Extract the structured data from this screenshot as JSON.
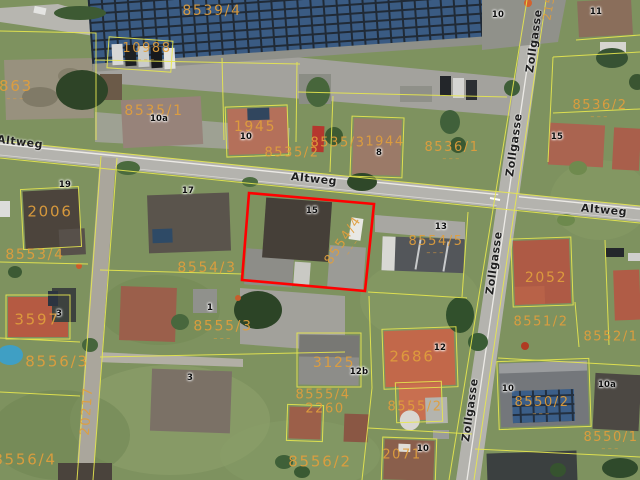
{
  "map": {
    "type": "aerial-cadastral-view",
    "colors": {
      "parcel_line": "#e8e84f",
      "parcel_label": "#e09e3c",
      "selection_outline": "#ff0000",
      "road": "#b4b3ae"
    },
    "selected_parcel": {
      "number": "8554/4",
      "house_number": "15",
      "outline_color": "#ff0000",
      "outline_points": "249,193 374,204 365,291 242,280"
    },
    "street_labels": [
      {
        "text": "Altweg",
        "x": 20,
        "y": 142,
        "rot": 7
      },
      {
        "text": "Altweg",
        "x": 314,
        "y": 179,
        "rot": 6
      },
      {
        "text": "Altweg",
        "x": 604,
        "y": 210,
        "rot": 5
      },
      {
        "text": "Zollgasse",
        "x": 534,
        "y": 41,
        "rot": -82
      },
      {
        "text": "Zollgasse",
        "x": 514,
        "y": 145,
        "rot": -82
      },
      {
        "text": "Zollgasse",
        "x": 494,
        "y": 263,
        "rot": -82
      },
      {
        "text": "Zollgasse",
        "x": 470,
        "y": 410,
        "rot": -82
      }
    ],
    "parcel_labels": [
      {
        "text": "8539/4",
        "x": 212,
        "y": 11,
        "size": 14
      },
      {
        "text": "10988",
        "x": 147,
        "y": 53,
        "size": 13,
        "dash": true
      },
      {
        "text": "863",
        "x": 16,
        "y": 91,
        "size": 15,
        "dash": true
      },
      {
        "text": "8535/1",
        "x": 154,
        "y": 111,
        "size": 14
      },
      {
        "text": "1945",
        "x": 255,
        "y": 127,
        "size": 14
      },
      {
        "text": "8535/2",
        "x": 292,
        "y": 153,
        "size": 13
      },
      {
        "text": "8535/3",
        "x": 338,
        "y": 143,
        "size": 13
      },
      {
        "text": "1944",
        "x": 385,
        "y": 142,
        "size": 13
      },
      {
        "text": "8536/1",
        "x": 452,
        "y": 152,
        "size": 13,
        "dash": true
      },
      {
        "text": "8536/2",
        "x": 600,
        "y": 110,
        "size": 13,
        "dash": true
      },
      {
        "text": "215",
        "x": 549,
        "y": 8,
        "size": 11,
        "rot": -80
      },
      {
        "text": "2006",
        "x": 50,
        "y": 212,
        "size": 15
      },
      {
        "text": "8553/4",
        "x": 35,
        "y": 255,
        "size": 14
      },
      {
        "text": "8554/3",
        "x": 207,
        "y": 268,
        "size": 14
      },
      {
        "text": "8554/4",
        "x": 347,
        "y": 243,
        "size": 13,
        "rot": -56,
        "dash": true
      },
      {
        "text": "8554/5",
        "x": 436,
        "y": 246,
        "size": 13,
        "dash": true
      },
      {
        "text": "3597",
        "x": 37,
        "y": 320,
        "size": 15
      },
      {
        "text": "8556/3",
        "x": 57,
        "y": 362,
        "size": 15
      },
      {
        "text": "8555/3",
        "x": 223,
        "y": 331,
        "size": 14,
        "dash": true
      },
      {
        "text": "20217",
        "x": 87,
        "y": 411,
        "size": 13,
        "rot": -86
      },
      {
        "text": "8556/4",
        "x": 25,
        "y": 460,
        "size": 15
      },
      {
        "text": "3125",
        "x": 334,
        "y": 363,
        "size": 14
      },
      {
        "text": "2686",
        "x": 412,
        "y": 357,
        "size": 15
      },
      {
        "text": "8555/4",
        "x": 323,
        "y": 395,
        "size": 13
      },
      {
        "text": "2260",
        "x": 325,
        "y": 409,
        "size": 13
      },
      {
        "text": "8555/2",
        "x": 415,
        "y": 407,
        "size": 13
      },
      {
        "text": "8556/2",
        "x": 320,
        "y": 462,
        "size": 15
      },
      {
        "text": "2071",
        "x": 402,
        "y": 455,
        "size": 13
      },
      {
        "text": "2052",
        "x": 546,
        "y": 278,
        "size": 14
      },
      {
        "text": "8551/2",
        "x": 541,
        "y": 322,
        "size": 13
      },
      {
        "text": "8552/1",
        "x": 611,
        "y": 337,
        "size": 13
      },
      {
        "text": "8550/2",
        "x": 542,
        "y": 407,
        "size": 13,
        "dash": true
      },
      {
        "text": "8550/1",
        "x": 611,
        "y": 442,
        "size": 13,
        "dash": true
      }
    ],
    "house_numbers": [
      {
        "text": "10",
        "x": 498,
        "y": 15
      },
      {
        "text": "11",
        "x": 596,
        "y": 12
      },
      {
        "text": "10a",
        "x": 159,
        "y": 119
      },
      {
        "text": "10",
        "x": 246,
        "y": 137
      },
      {
        "text": "8",
        "x": 379,
        "y": 153
      },
      {
        "text": "15",
        "x": 557,
        "y": 137
      },
      {
        "text": "19",
        "x": 65,
        "y": 185
      },
      {
        "text": "17",
        "x": 188,
        "y": 191
      },
      {
        "text": "15",
        "x": 312,
        "y": 211
      },
      {
        "text": "13",
        "x": 441,
        "y": 227
      },
      {
        "text": "1",
        "x": 210,
        "y": 308
      },
      {
        "text": "3",
        "x": 59,
        "y": 314
      },
      {
        "text": "3",
        "x": 190,
        "y": 378
      },
      {
        "text": "12",
        "x": 440,
        "y": 348
      },
      {
        "text": "12b",
        "x": 359,
        "y": 372
      },
      {
        "text": "10",
        "x": 508,
        "y": 389
      },
      {
        "text": "10a",
        "x": 607,
        "y": 385
      },
      {
        "text": "10",
        "x": 423,
        "y": 449
      }
    ]
  }
}
